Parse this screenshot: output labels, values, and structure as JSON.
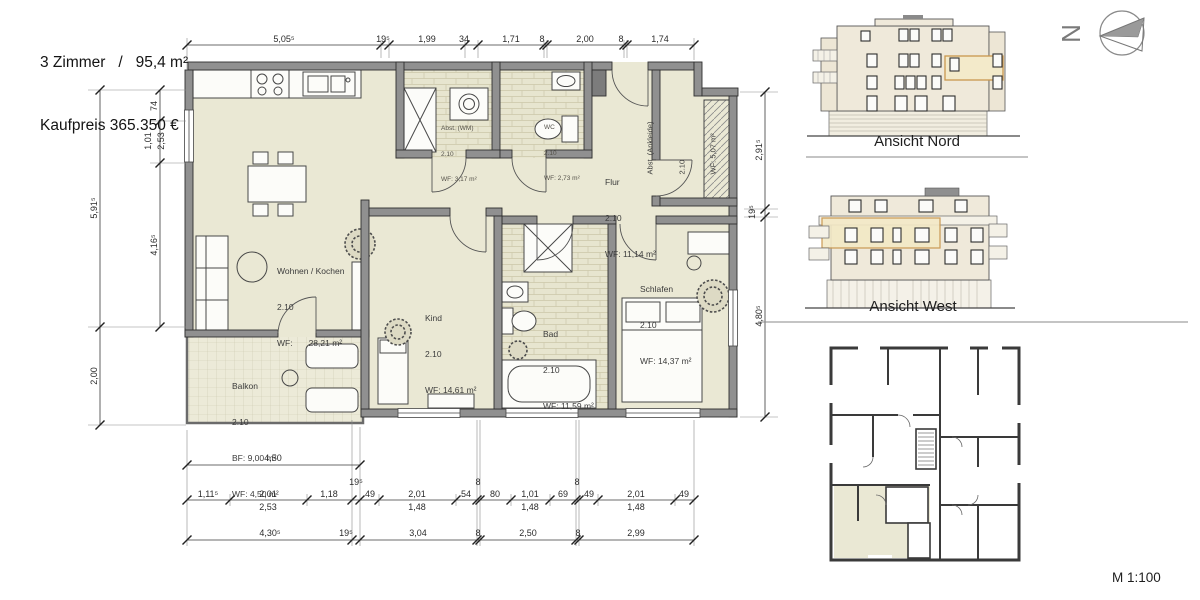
{
  "header": {
    "line1": "3 Zimmer   /   95,4 m²",
    "line2": "Kaufpreis 365.350 €"
  },
  "compass": {
    "north": "N"
  },
  "scale": {
    "label": "M 1:100"
  },
  "panels": {
    "ansicht_nord": "Ansicht Nord",
    "ansicht_west": "Ansicht West"
  },
  "rooms": {
    "wohnen": {
      "name": "Wohnen / Kochen",
      "height": "2.10",
      "wf_label": "WF:",
      "wf_value": "28,21 m²"
    },
    "kind": {
      "name": "Kind",
      "height": "2.10",
      "area": "WF: 14,61 m²"
    },
    "bad": {
      "name": "Bad",
      "height": "2.10",
      "area": "WF: 11,59 m²"
    },
    "flur": {
      "name": "Flur",
      "height": "2.10",
      "area": "WF: 11,14 m²"
    },
    "schlafen": {
      "name": "Schlafen",
      "height": "2.10",
      "area": "WF: 14,37 m²"
    },
    "balkon": {
      "name": "Balkon",
      "height": "2.10",
      "bf": "BF: 9,00 m²",
      "area": "WF: 4,50 m²"
    },
    "abst_wm": {
      "name": "Abst. (WM)",
      "height": "2.10",
      "area": "WF: 3,17 m²"
    },
    "wc": {
      "name": "WC",
      "height": "2.10",
      "area": "WF: 2,73 m²"
    },
    "ankleide": {
      "name": "Abst. (Ankleide)",
      "height": "2.10",
      "area": "WF: 5,07 m²"
    }
  },
  "dims": {
    "top": [
      "5,05⁵",
      "19⁵",
      "1,99",
      "34",
      "1,71",
      "8",
      "2,00",
      "8",
      "1,74"
    ],
    "left_outer": [
      "5,91⁵",
      "2,00"
    ],
    "left_inner": [
      "74",
      "1,01",
      "2,53",
      "4,16⁵"
    ],
    "right": [
      "2,91⁵",
      "19⁵",
      "4,80⁵"
    ],
    "balkon_width": "4,50",
    "row1": [
      "1,11⁵",
      "2,01",
      "1,18",
      "19⁵",
      "49",
      "2,01",
      "54",
      "8",
      "80",
      "1,01",
      "69",
      "8",
      "49",
      "2,01",
      "49"
    ],
    "row1_sub": [
      "2,53",
      "1,48",
      "1,48",
      "1,48"
    ],
    "row2": [
      "4,30⁵",
      "19⁵",
      "3,04",
      "8",
      "2,50",
      "8",
      "2,99"
    ]
  },
  "colors": {
    "room_fill": "#EAE8D4",
    "wall": "#909090",
    "facade": "#EFE9DA",
    "highlight_fill": "#F3EACA",
    "highlight_stroke": "#C9974E"
  }
}
